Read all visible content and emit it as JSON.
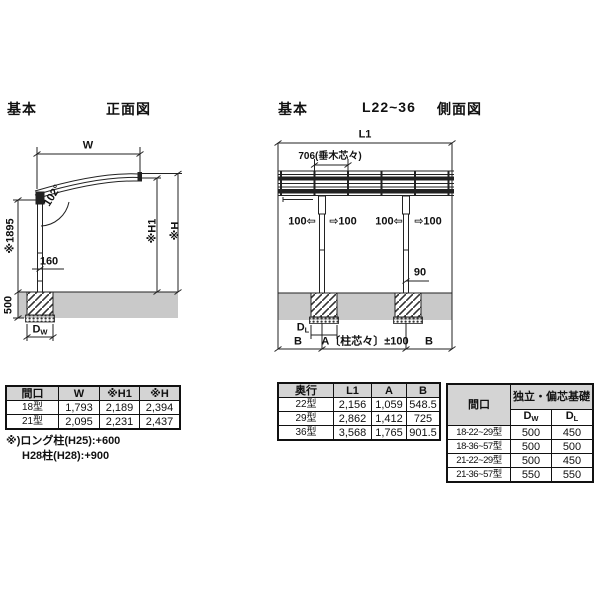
{
  "colors": {
    "line": "#222222",
    "ground": "#c9c9c9",
    "header_bg": "#d4d4d4",
    "paper": "#ffffff"
  },
  "front_view": {
    "section_label": "基本",
    "title": "正面図",
    "dims": {
      "width": "W",
      "angle": "102°",
      "post_height": "※1895",
      "offset_160": "160",
      "embed_depth": "500",
      "footing_w_base": "D",
      "footing_w_sub": "W",
      "h1": "※H1",
      "h": "※H"
    }
  },
  "side_view": {
    "section_label": "基本",
    "model_range": "L22~36",
    "title": "側面図",
    "dims": {
      "l1": "L1",
      "rafter_pitch": "706(垂木芯々)",
      "adjust_value": "100",
      "arrow_left": "⇦",
      "arrow_right": "⇨",
      "dim_90": "90",
      "footing_l_base": "D",
      "footing_l_sub": "L",
      "b_left": "B",
      "a_span": "A〔柱芯々〕±100",
      "b_right": "B"
    }
  },
  "tables": {
    "spec": {
      "headers": [
        "間口",
        "W",
        "※H1",
        "※H"
      ],
      "rows": [
        [
          "18型",
          "1,793",
          "2,189",
          "2,394"
        ],
        [
          "21型",
          "2,095",
          "2,231",
          "2,437"
        ]
      ],
      "notes": [
        "※)ロング柱(H25):+600",
        "H28柱(H28):+900"
      ]
    },
    "depth": {
      "headers": [
        "奥行",
        "L1",
        "A",
        "B"
      ],
      "rows": [
        [
          "22型",
          "2,156",
          "1,059",
          "548.5"
        ],
        [
          "29型",
          "2,862",
          "1,412",
          "725"
        ],
        [
          "36型",
          "3,568",
          "1,765",
          "901.5"
        ]
      ]
    },
    "foundation": {
      "col_header": "間口",
      "group_header": "独立・偏芯基礎",
      "sub_headers": [
        {
          "base": "D",
          "sub": "W"
        },
        {
          "base": "D",
          "sub": "L"
        }
      ],
      "rows": [
        [
          "18-22~29型",
          "500",
          "450"
        ],
        [
          "18-36~57型",
          "500",
          "500"
        ],
        [
          "21-22~29型",
          "500",
          "450"
        ],
        [
          "21-36~57型",
          "550",
          "550"
        ]
      ]
    }
  }
}
